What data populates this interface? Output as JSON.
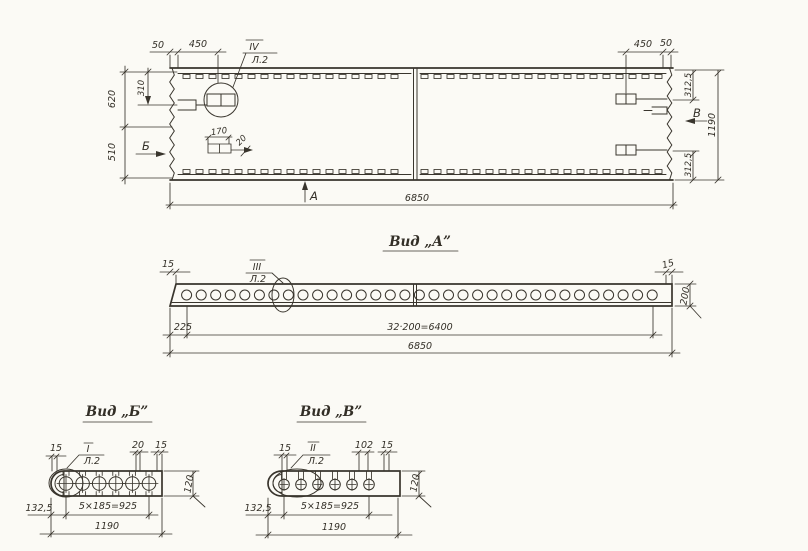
{
  "palette": {
    "paper": "#fbfaf5",
    "ink": "#39352d"
  },
  "top_view": {
    "callout": {
      "ref": "IV",
      "sheet": "Л.2"
    },
    "markers": {
      "section_b": "Б",
      "view_a": "А",
      "section_v": "В"
    },
    "dims": {
      "edge_50_left": "50",
      "insert_450_left": "450",
      "height_620": "620",
      "inset_310": "310",
      "height_510": "510",
      "detail_170": "170",
      "detail_20": "20",
      "length_6850": "6850",
      "insert_450_right": "450",
      "edge_50_right": "50",
      "offset_3125_top": "312,5",
      "width_1190": "1190",
      "offset_3125_bottom": "312,5"
    }
  },
  "view_a": {
    "title": "Вид „А”",
    "callout": {
      "ref": "III",
      "sheet": "Л.2"
    },
    "hole_count": 33,
    "dims": {
      "edge_15_left": "15",
      "edge_15_right": "15",
      "height_200": "200",
      "offset_225": "225",
      "holes_spacing": "32·200=6400",
      "length_6850": "6850"
    }
  },
  "view_b": {
    "title": "Вид „Б”",
    "callout": {
      "ref": "I",
      "sheet": "Л.2"
    },
    "hole_count": 6,
    "dims": {
      "edge_15_left": "15",
      "stud_20": "20",
      "edge_15_right": "15",
      "height_120": "120",
      "offset_1325": "132,5",
      "holes_spacing": "5×185=925",
      "length_1190": "1190"
    }
  },
  "view_v": {
    "title": "Вид „В”",
    "callout": {
      "ref": "II",
      "sheet": "Л.2"
    },
    "hole_count": 6,
    "dims": {
      "edge_15_left": "15",
      "stud_102": "102",
      "edge_15_right": "15",
      "height_120": "120",
      "offset_1325": "132,5",
      "holes_spacing": "5×185=925",
      "length_1190": "1190"
    }
  }
}
